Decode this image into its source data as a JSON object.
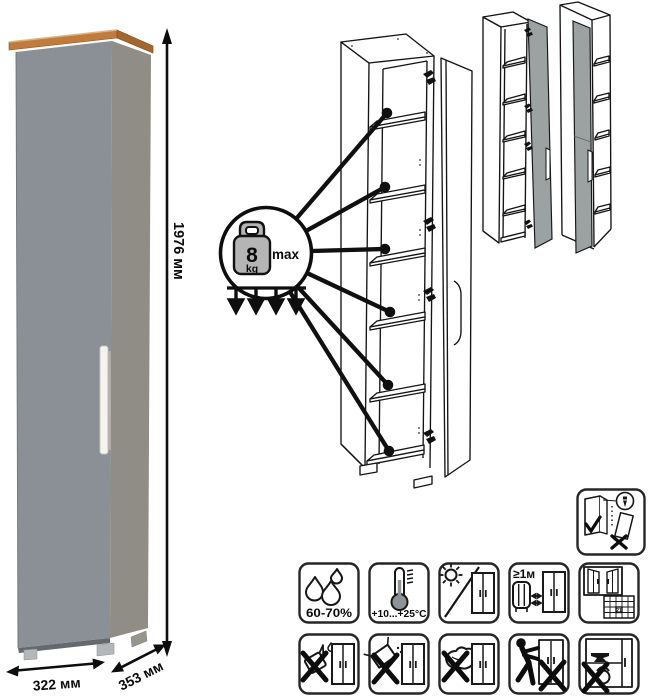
{
  "photo": {
    "height_label": "1976 мм",
    "width_label": "322 мм",
    "depth_label": "353 мм"
  },
  "load_limit": {
    "value": "8",
    "unit": "kg",
    "max_label": "max"
  },
  "care": {
    "humidity_label": "60-70%",
    "temperature_label": "+10...+25°C",
    "distance_label": "≥1м",
    "calendar_day": "21"
  },
  "colors": {
    "door_gray": "#8A9095",
    "side_gray": "#8F8D85",
    "wood": "#BF7C3E",
    "wood_side": "#A3662E",
    "variant_door": "#9CA1A1",
    "weight_fill": "#B5B5B5",
    "line": "#141414"
  }
}
